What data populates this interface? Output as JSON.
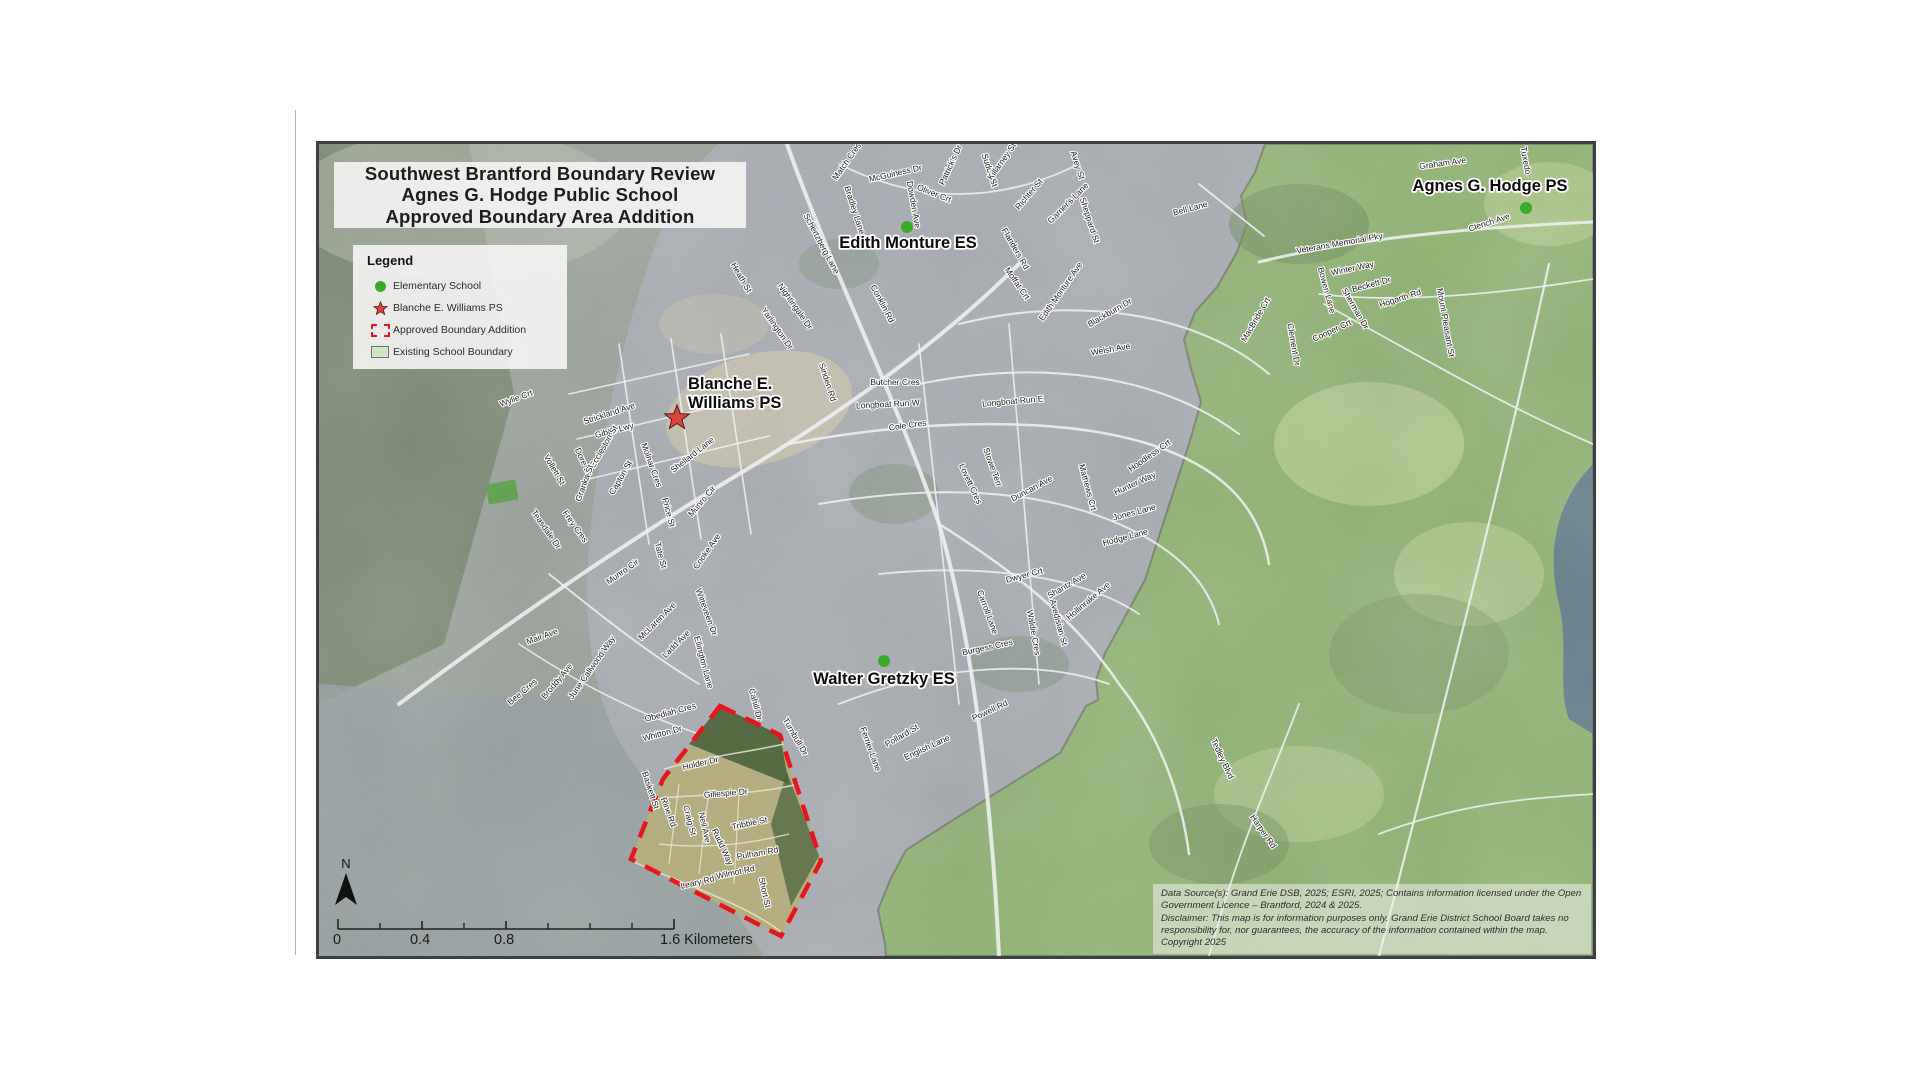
{
  "title": {
    "lines": [
      "Southwest Brantford Boundary Review",
      "Agnes G. Hodge Public School",
      "Approved Boundary Area Addition"
    ]
  },
  "legend": {
    "heading": "Legend",
    "items": [
      {
        "label": "Elementary School",
        "symbol": "green-dot"
      },
      {
        "label": "Blanche E. Williams PS",
        "symbol": "red-star"
      },
      {
        "label": "Approved Boundary Addition",
        "symbol": "red-dashed-outline"
      },
      {
        "label": "Existing School Boundary",
        "symbol": "green-fill"
      }
    ]
  },
  "map": {
    "schools": [
      {
        "name": "Edith Monture ES",
        "marker": "green-dot"
      },
      {
        "name": "Agnes G. Hodge PS",
        "marker": "green-dot"
      },
      {
        "lines": [
          "Blanche E.",
          "Williams PS"
        ],
        "marker": "red-star"
      },
      {
        "name": "Walter Gretzky ES",
        "marker": "green-dot"
      }
    ],
    "street_labels": [
      {
        "t": "Wylie Crt",
        "x": 198,
        "y": 257,
        "r": -20
      },
      {
        "t": "Strickland Ave",
        "x": 291,
        "y": 272,
        "r": -18
      },
      {
        "t": "Gibbs Lwy",
        "x": 296,
        "y": 289,
        "r": -15
      },
      {
        "t": "Eccleston St",
        "x": 287,
        "y": 304,
        "r": -60
      },
      {
        "t": "Dore Dr",
        "x": 262,
        "y": 319,
        "r": 65
      },
      {
        "t": "Vollett St",
        "x": 233,
        "y": 327,
        "r": 60
      },
      {
        "t": "Granka St",
        "x": 268,
        "y": 340,
        "r": -70
      },
      {
        "t": "Capton St",
        "x": 304,
        "y": 335,
        "r": -60
      },
      {
        "t": "Molnar Cres",
        "x": 330,
        "y": 322,
        "r": 70
      },
      {
        "t": "Shellard Lane",
        "x": 375,
        "y": 313,
        "r": -38
      },
      {
        "t": "Munro Cir",
        "x": 385,
        "y": 359,
        "r": -50
      },
      {
        "t": "Price St",
        "x": 347,
        "y": 369,
        "r": 75
      },
      {
        "t": "Tate St",
        "x": 339,
        "y": 412,
        "r": 75
      },
      {
        "t": "Cooke Ave",
        "x": 390,
        "y": 409,
        "r": -55
      },
      {
        "t": "Munro Cir",
        "x": 305,
        "y": 430,
        "r": -35
      },
      {
        "t": "Teasdale Dr",
        "x": 225,
        "y": 387,
        "r": 55
      },
      {
        "t": "Frey Cres",
        "x": 254,
        "y": 384,
        "r": 55
      },
      {
        "t": "Mair Ave",
        "x": 224,
        "y": 495,
        "r": -20
      },
      {
        "t": "McLaren Ave",
        "x": 340,
        "y": 479,
        "r": -45
      },
      {
        "t": "Ladd Ave",
        "x": 359,
        "y": 502,
        "r": -45
      },
      {
        "t": "Witteveen Dr",
        "x": 385,
        "y": 469,
        "r": 70
      },
      {
        "t": "Ellington Lane",
        "x": 382,
        "y": 519,
        "r": 75
      },
      {
        "t": "Broddy Ave",
        "x": 240,
        "y": 539,
        "r": -50
      },
      {
        "t": "June Callwood Way",
        "x": 275,
        "y": 525,
        "r": -55
      },
      {
        "t": "Bee Cres",
        "x": 205,
        "y": 550,
        "r": -40
      },
      {
        "t": "Match Cres",
        "x": 530,
        "y": 19,
        "r": -55
      },
      {
        "t": "McGuiness Dr",
        "x": 577,
        "y": 32,
        "r": -13
      },
      {
        "t": "Bradley Lane",
        "x": 533,
        "y": 67,
        "r": 72
      },
      {
        "t": "Schertzberg Lane",
        "x": 500,
        "y": 101,
        "r": 62
      },
      {
        "t": "Dowden Ave",
        "x": 592,
        "y": 61,
        "r": 80
      },
      {
        "t": "Oliver Crt",
        "x": 614,
        "y": 52,
        "r": 22
      },
      {
        "t": "Patrick's Dr",
        "x": 634,
        "y": 22,
        "r": -65
      },
      {
        "t": "Sudds St",
        "x": 668,
        "y": 27,
        "r": 72
      },
      {
        "t": "Killarney St",
        "x": 685,
        "y": 19,
        "r": -55
      },
      {
        "t": "Richter St",
        "x": 712,
        "y": 52,
        "r": -50
      },
      {
        "t": "Garner's Lane",
        "x": 751,
        "y": 61,
        "r": -45
      },
      {
        "t": "Avey St",
        "x": 756,
        "y": 22,
        "r": 72
      },
      {
        "t": "Sheppard St",
        "x": 768,
        "y": 77,
        "r": 72
      },
      {
        "t": "Flanders Rd",
        "x": 694,
        "y": 106,
        "r": 60
      },
      {
        "t": "Heath St",
        "x": 420,
        "y": 135,
        "r": 60
      },
      {
        "t": "Nightingale Dr",
        "x": 474,
        "y": 164,
        "r": 55
      },
      {
        "t": "Yarlington Dr",
        "x": 456,
        "y": 186,
        "r": 55
      },
      {
        "t": "Sinden Rd",
        "x": 506,
        "y": 239,
        "r": 72
      },
      {
        "t": "Conklin Rd",
        "x": 561,
        "y": 161,
        "r": 62
      },
      {
        "t": "Butcher Cres",
        "x": 576,
        "y": 241,
        "r": 0
      },
      {
        "t": "Longboat Run W",
        "x": 569,
        "y": 263,
        "r": -3
      },
      {
        "t": "Longboat Run E",
        "x": 694,
        "y": 260,
        "r": -5
      },
      {
        "t": "Cole Cres",
        "x": 589,
        "y": 284,
        "r": -8
      },
      {
        "t": "Moffat Crt",
        "x": 696,
        "y": 141,
        "r": 55
      },
      {
        "t": "Edith Monture Ave",
        "x": 744,
        "y": 149,
        "r": -55
      },
      {
        "t": "Blackburn Dr",
        "x": 792,
        "y": 171,
        "r": -30
      },
      {
        "t": "Welsh Ave",
        "x": 792,
        "y": 208,
        "r": -10
      },
      {
        "t": "Stowe Terr",
        "x": 671,
        "y": 324,
        "r": 70
      },
      {
        "t": "Lovett Cres",
        "x": 649,
        "y": 341,
        "r": 65
      },
      {
        "t": "Duncan Ave",
        "x": 714,
        "y": 347,
        "r": -28
      },
      {
        "t": "Mathews Crt",
        "x": 766,
        "y": 344,
        "r": 75
      },
      {
        "t": "Hoodless Crt",
        "x": 832,
        "y": 314,
        "r": -35
      },
      {
        "t": "Hunter Way",
        "x": 817,
        "y": 342,
        "r": -25
      },
      {
        "t": "Jones Lane",
        "x": 816,
        "y": 371,
        "r": -15
      },
      {
        "t": "Hodge Lane",
        "x": 807,
        "y": 396,
        "r": -15
      },
      {
        "t": "Dwyer Crt",
        "x": 706,
        "y": 434,
        "r": -15
      },
      {
        "t": "Shantz Ave",
        "x": 749,
        "y": 444,
        "r": -30
      },
      {
        "t": "Hollinrake Ave",
        "x": 771,
        "y": 459,
        "r": -40
      },
      {
        "t": "Avedisian St",
        "x": 737,
        "y": 479,
        "r": 75
      },
      {
        "t": "Waldie Cres",
        "x": 712,
        "y": 489,
        "r": 80
      },
      {
        "t": "Carroll Lane",
        "x": 666,
        "y": 469,
        "r": 70
      },
      {
        "t": "Burgess Cres",
        "x": 669,
        "y": 506,
        "r": -12
      },
      {
        "t": "Powell Rd",
        "x": 672,
        "y": 569,
        "r": -25
      },
      {
        "t": "Pollard St",
        "x": 584,
        "y": 594,
        "r": -30
      },
      {
        "t": "English Lane",
        "x": 609,
        "y": 606,
        "r": -25
      },
      {
        "t": "Ferrier Lane",
        "x": 549,
        "y": 606,
        "r": 70
      },
      {
        "t": "Tedley Blvd",
        "x": 901,
        "y": 616,
        "r": 65
      },
      {
        "t": "Harper Rd",
        "x": 942,
        "y": 689,
        "r": 55
      },
      {
        "t": "Bell Lane",
        "x": 872,
        "y": 67,
        "r": -15
      },
      {
        "t": "Veterans Memorial Pky",
        "x": 1021,
        "y": 102,
        "r": -10
      },
      {
        "t": "Winter Way",
        "x": 1034,
        "y": 127,
        "r": -12
      },
      {
        "t": "Bowen Lane",
        "x": 1005,
        "y": 147,
        "r": 75
      },
      {
        "t": "Beckett Dr",
        "x": 1053,
        "y": 143,
        "r": -15
      },
      {
        "t": "Sherman Dr",
        "x": 1034,
        "y": 166,
        "r": 60
      },
      {
        "t": "Hogarth Rd",
        "x": 1082,
        "y": 157,
        "r": -18
      },
      {
        "t": "Cooper Crt",
        "x": 1014,
        "y": 189,
        "r": -25
      },
      {
        "t": "MacBride Crt",
        "x": 939,
        "y": 177,
        "r": -60
      },
      {
        "t": "Clement Dr",
        "x": 972,
        "y": 201,
        "r": 80
      },
      {
        "t": "Mount Pleasant St",
        "x": 1124,
        "y": 179,
        "r": 80
      },
      {
        "t": "Graham Ave",
        "x": 1124,
        "y": 22,
        "r": -8
      },
      {
        "t": "Tuxedo",
        "x": 1204,
        "y": 17,
        "r": 80
      },
      {
        "t": "Clench Ave",
        "x": 1171,
        "y": 81,
        "r": -18
      },
      {
        "t": "Obediah Cres",
        "x": 352,
        "y": 571,
        "r": -15
      },
      {
        "t": "Whitton Dr",
        "x": 344,
        "y": 592,
        "r": -15
      },
      {
        "t": "Cahill Dr",
        "x": 434,
        "y": 561,
        "r": 75
      },
      {
        "t": "Turnbull Dr",
        "x": 474,
        "y": 594,
        "r": 60
      },
      {
        "t": "Holder Dr",
        "x": 382,
        "y": 622,
        "r": -13
      },
      {
        "t": "Gillespie Dr",
        "x": 407,
        "y": 652,
        "r": -5
      },
      {
        "t": "Baskett St",
        "x": 329,
        "y": 647,
        "r": 72
      },
      {
        "t": "Rine Rd",
        "x": 347,
        "y": 669,
        "r": 70
      },
      {
        "t": "Craig St",
        "x": 368,
        "y": 677,
        "r": 75
      },
      {
        "t": "Neil Ave",
        "x": 383,
        "y": 684,
        "r": 78
      },
      {
        "t": "Rudd Way",
        "x": 401,
        "y": 704,
        "r": 65
      },
      {
        "t": "Tribble St",
        "x": 431,
        "y": 682,
        "r": -12
      },
      {
        "t": "Pulham Rd",
        "x": 439,
        "y": 712,
        "r": -10
      },
      {
        "t": "Wilmot Rd",
        "x": 417,
        "y": 731,
        "r": -12
      },
      {
        "t": "Leary Rd",
        "x": 379,
        "y": 741,
        "r": -13
      },
      {
        "t": "Short St",
        "x": 443,
        "y": 749,
        "r": 78
      }
    ]
  },
  "scalebar": {
    "labels": [
      "0",
      "0.4",
      "0.8",
      "1.6 Kilometers"
    ]
  },
  "north_label": "N",
  "disclaimer": {
    "lines": [
      "Data Source(s): Grand Erie DSB, 2025; ESRI, 2025; Contains information licensed under the Open Government Licence – Brantford, 2024 & 2025.",
      "Disclaimer: This map is for information purposes only. Grand Erie District School Board takes no responsibility for, nor guarantees, the accuracy of the information contained within the map.",
      "Copyright 2025"
    ]
  },
  "colors": {
    "approved_boundary_red": "#e8151c",
    "elementary_school_green": "#3aab28",
    "existing_boundary_fill": "#cfe6c4",
    "blanche_star_red": "#d9453e",
    "urban_gray": "#a8adb3",
    "boundary_area_green": "#8fb471"
  }
}
